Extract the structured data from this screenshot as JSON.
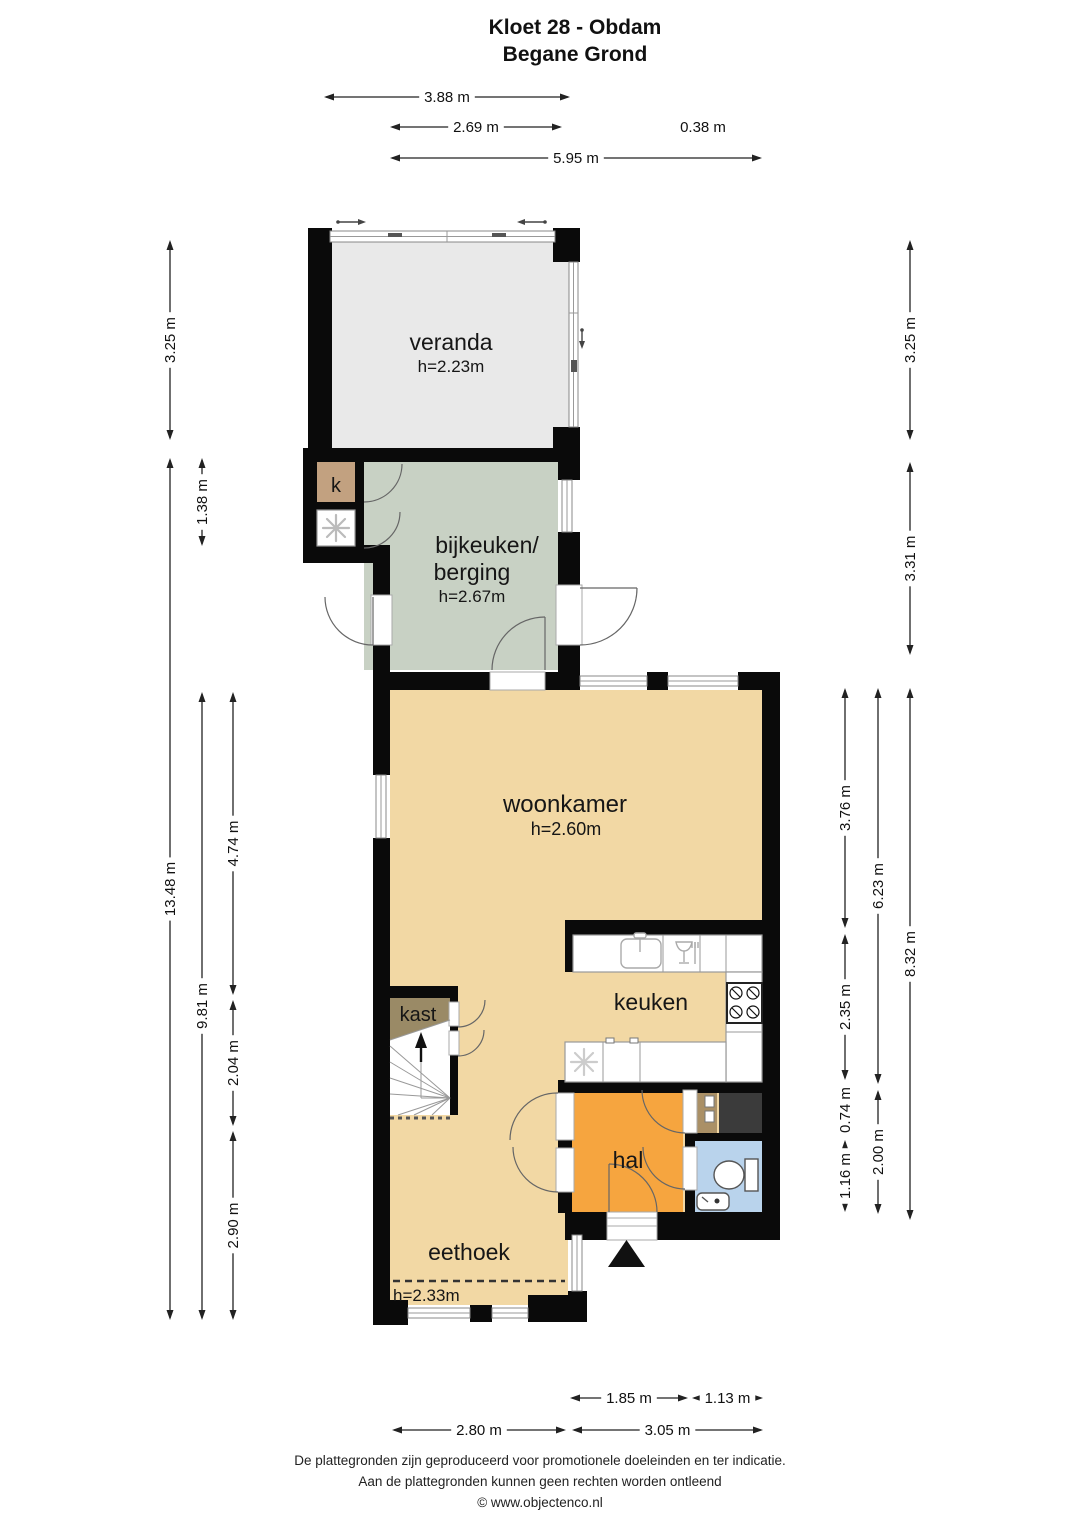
{
  "title": {
    "line1": "Kloet 28 - Obdam",
    "line2": "Begane Grond"
  },
  "rooms": {
    "veranda": {
      "name": "veranda",
      "height": "h=2.23m"
    },
    "k_closet": {
      "name": "k"
    },
    "bijkeuken": {
      "name_line1": "bijkeuken/",
      "name_line2": "berging",
      "height": "h=2.67m"
    },
    "woonkamer": {
      "name": "woonkamer",
      "height": "h=2.60m"
    },
    "keuken": {
      "name": "keuken"
    },
    "kast": {
      "name": "kast"
    },
    "hal": {
      "name": "hal"
    },
    "eethoek": {
      "name": "eethoek",
      "height_note": "h=2.33m"
    }
  },
  "dimensions": {
    "top": [
      {
        "label": "3.88 m",
        "x1": 324,
        "x2": 570,
        "y": 97
      },
      {
        "label": "2.69 m",
        "x1": 390,
        "x2": 562,
        "y": 127
      },
      {
        "label": "0.38 m",
        "x": 703,
        "y": 127,
        "text_only": true
      },
      {
        "label": "5.95 m",
        "x1": 390,
        "x2": 762,
        "y": 158
      }
    ],
    "bottom": [
      {
        "label": "1.85 m",
        "x1": 570,
        "x2": 688,
        "y": 1398
      },
      {
        "label": "1.13 m",
        "x1": 692,
        "x2": 763,
        "y": 1398
      },
      {
        "label": "2.80 m",
        "x1": 392,
        "x2": 566,
        "y": 1430
      },
      {
        "label": "3.05 m",
        "x1": 572,
        "x2": 763,
        "y": 1430
      }
    ],
    "left": [
      {
        "label": "3.25 m",
        "x": 170,
        "y1": 240,
        "y2": 440
      },
      {
        "label": "1.38 m",
        "x": 202,
        "y1": 458,
        "y2": 546
      },
      {
        "label": "13.48 m",
        "x": 170,
        "y1": 458,
        "y2": 1320
      },
      {
        "label": "9.81 m",
        "x": 202,
        "y1": 692,
        "y2": 1320
      },
      {
        "label": "4.74 m",
        "x": 233,
        "y1": 692,
        "y2": 995
      },
      {
        "label": "2.04 m",
        "x": 233,
        "y1": 1000,
        "y2": 1126
      },
      {
        "label": "2.90 m",
        "x": 233,
        "y1": 1131,
        "y2": 1320
      }
    ],
    "right": [
      {
        "label": "3.25 m",
        "x": 910,
        "y1": 240,
        "y2": 440
      },
      {
        "label": "3.31 m",
        "x": 910,
        "y1": 462,
        "y2": 655
      },
      {
        "label": "3.76 m",
        "x": 845,
        "y1": 688,
        "y2": 928
      },
      {
        "label": "2.35 m",
        "x": 845,
        "y1": 934,
        "y2": 1080
      },
      {
        "label": "0.74 m",
        "x": 845,
        "y1": 1086,
        "y2": 1134
      },
      {
        "label": "1.16 m",
        "x": 845,
        "y1": 1140,
        "y2": 1212
      },
      {
        "label": "6.23 m",
        "x": 878,
        "y1": 688,
        "y2": 1084
      },
      {
        "label": "2.00 m",
        "x": 878,
        "y1": 1090,
        "y2": 1214
      },
      {
        "label": "8.32 m",
        "x": 910,
        "y1": 688,
        "y2": 1220
      }
    ]
  },
  "footer": {
    "line1": "De plattegronden zijn geproduceerd voor promotionele doeleinden en ter indicatie.",
    "line2": "Aan de plattegronden kunnen geen rechten worden ontleend",
    "line3": "© www.objectenco.nl"
  },
  "colors": {
    "wall": "#0a0a0a",
    "veranda": "#e9e9e9",
    "bijkeuken": "#c8d1c4",
    "woonkamer": "#f2d8a4",
    "hal": "#f6a53f",
    "toilet": "#b9d3ec",
    "k_closet": "#c2a180",
    "kast": "#9a8a66",
    "cabinet_strip": "#aa9066",
    "dark_unit": "#3b3b3b"
  }
}
